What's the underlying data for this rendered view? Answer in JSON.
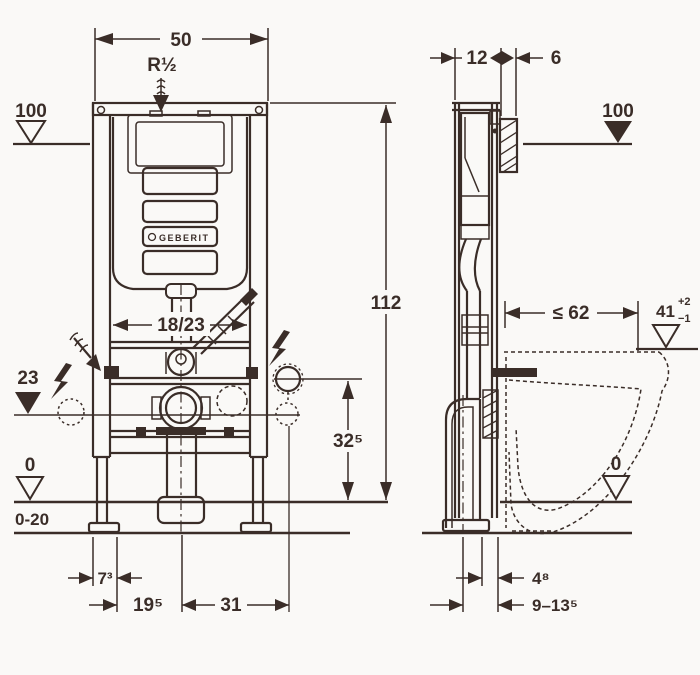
{
  "drawing": {
    "title": "Wall-hung WC installation element - dimensioned drawing",
    "brand_logo": "GEBERIT"
  },
  "colors": {
    "line": "#3a2d28",
    "background": "#faf9f7"
  },
  "front_view": {
    "dim_frame_width": "50",
    "water_supply": "R½",
    "datum_supply_height": "100",
    "dim_frame_height": "112",
    "dim_flush_bend": "18/23",
    "datum_connection_height": "23",
    "dim_socket_height": "32⁵",
    "datum_floor": "0",
    "floor_buildup_range": "0-20",
    "dim_foot_width": "7³",
    "dim_outlet_offset": "19⁵",
    "dim_socket_offset": "31"
  },
  "side_view": {
    "dim_frame_depth": "12",
    "dim_plate_depth": "6",
    "datum_supply_height": "100",
    "dim_bowl_depth_max": "≤ 62",
    "dim_rim_height": "41",
    "rim_tol_plus": "+2",
    "rim_tol_minus": "−1",
    "datum_floor": "0",
    "dim_outlet_wall_gap": "4⁸",
    "dim_bolt_range": "9–13⁵"
  },
  "symbols": {
    "lightning": "electrical-connection",
    "hatched_arrow": "water-supply-inlet",
    "open_triangle": "datum-level-open",
    "filled_triangle": "datum-level-filled",
    "dashed_circle": "knockout-opening",
    "dashed_outline": "ceramic-pan-reference"
  }
}
